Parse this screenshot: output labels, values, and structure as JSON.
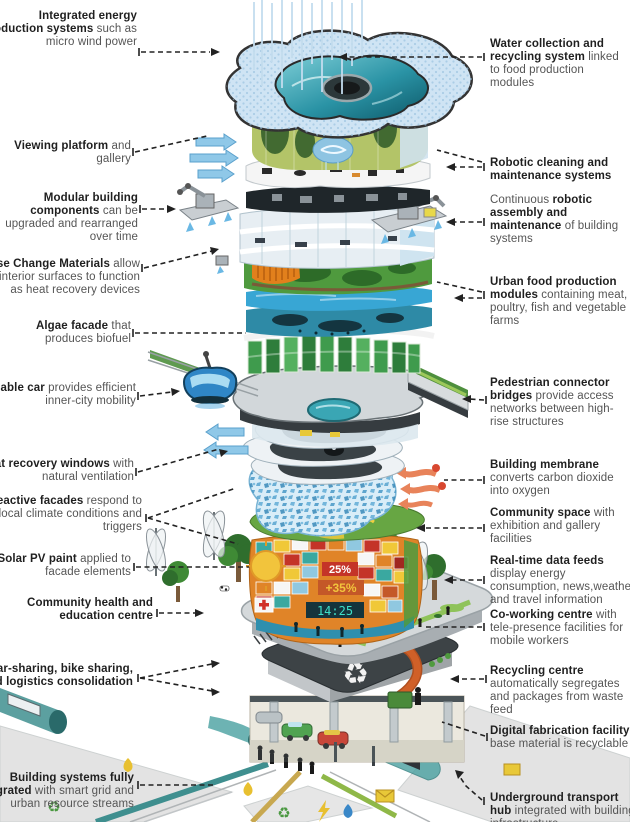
{
  "labels": {
    "left": [
      {
        "segments": [
          {
            "t": "Integrated energy production systems",
            "b": true
          },
          {
            "t": " such as micro wind power",
            "b": false
          }
        ]
      },
      {
        "segments": [
          {
            "t": "Viewing platform",
            "b": true
          },
          {
            "t": " and gallery",
            "b": false
          }
        ]
      },
      {
        "segments": [
          {
            "t": "Modular building components",
            "b": true
          },
          {
            "t": " can be upgraded and rearranged over time",
            "b": false
          }
        ]
      },
      {
        "segments": [
          {
            "t": "Phase Change Materials",
            "b": true
          },
          {
            "t": " allow for interior surfaces to function as heat recovery devices",
            "b": false
          }
        ]
      },
      {
        "segments": [
          {
            "t": "Algae facade",
            "b": true
          },
          {
            "t": " that produces biofuel",
            "b": false
          }
        ]
      },
      {
        "segments": [
          {
            "t": "Cable car",
            "b": true
          },
          {
            "t": " provides efficient inner-city mobility",
            "b": false
          }
        ]
      },
      {
        "segments": [
          {
            "t": "Heat recovery windows",
            "b": true
          },
          {
            "t": " with natural ventilation",
            "b": false
          }
        ]
      },
      {
        "segments": [
          {
            "t": "Reactive facades",
            "b": true
          },
          {
            "t": " respond to local climate conditions and triggers",
            "b": false
          }
        ]
      },
      {
        "segments": [
          {
            "t": "Solar PV paint",
            "b": true
          },
          {
            "t": " applied to facade elements",
            "b": false
          }
        ]
      },
      {
        "segments": [
          {
            "t": "Community health and education centre",
            "b": true
          }
        ]
      },
      {
        "segments": [
          {
            "t": "Car-sharing, bike sharing, and logistics consolidation",
            "b": true
          }
        ]
      },
      {
        "segments": [
          {
            "t": "Building systems fully integrated",
            "b": true
          },
          {
            "t": " with smart grid and urban resource streams",
            "b": false
          }
        ]
      }
    ],
    "right": [
      {
        "segments": [
          {
            "t": "Water collection and recycling system",
            "b": true
          },
          {
            "t": " linked to food production modules",
            "b": false
          }
        ]
      },
      {
        "segments": [
          {
            "t": "Robotic cleaning and maintenance systems",
            "b": true
          }
        ]
      },
      {
        "segments": [
          {
            "t": "Continuous ",
            "b": false
          },
          {
            "t": "robotic assembly and maintenance",
            "b": true
          },
          {
            "t": " of building systems",
            "b": false
          }
        ]
      },
      {
        "segments": [
          {
            "t": "Urban food production modules",
            "b": true
          },
          {
            "t": " containing meat, poultry, fish and vegetable farms",
            "b": false
          }
        ]
      },
      {
        "segments": [
          {
            "t": "Pedestrian connector bridges",
            "b": true
          },
          {
            "t": " provide access networks between high-rise structures",
            "b": false
          }
        ]
      },
      {
        "segments": [
          {
            "t": "Building membrane",
            "b": true
          },
          {
            "t": " converts carbon dioxide into oxygen",
            "b": false
          }
        ]
      },
      {
        "segments": [
          {
            "t": "Community space",
            "b": true
          },
          {
            "t": " with exhibition and gallery facilities",
            "b": false
          }
        ]
      },
      {
        "segments": [
          {
            "t": "Real-time data feeds",
            "b": true
          },
          {
            "t": " display energy consumption, news,weather and travel information",
            "b": false
          }
        ]
      },
      {
        "segments": [
          {
            "t": "Co-working centre",
            "b": true
          },
          {
            "t": " with tele-presence facilities for mobile workers",
            "b": false
          }
        ]
      },
      {
        "segments": [
          {
            "t": "Recycling centre",
            "b": true
          },
          {
            "t": " automatically segregates and packages from waste feed",
            "b": false
          }
        ]
      },
      {
        "segments": [
          {
            "t": "Digital fabrication facility",
            "b": true
          },
          {
            "t": " base material is recyclable",
            "b": false
          }
        ]
      },
      {
        "segments": [
          {
            "t": "Underground transport hub",
            "b": true
          },
          {
            "t": " integrated with building infrastructure",
            "b": false
          }
        ]
      }
    ]
  },
  "displays": {
    "energy_pct": "25%",
    "energy_delta": "+35%",
    "clock": "14:25"
  },
  "icons": {
    "recycle": "♻",
    "recycle_small": "♻"
  },
  "colors": {
    "leader": "#222222",
    "pool_teal": "#0e6e80",
    "membrane_blue": "#4fa0cc",
    "facade_orange": "#e08428",
    "algae_green": "#3f9b4d",
    "display_teal": "#3ee0c8"
  }
}
